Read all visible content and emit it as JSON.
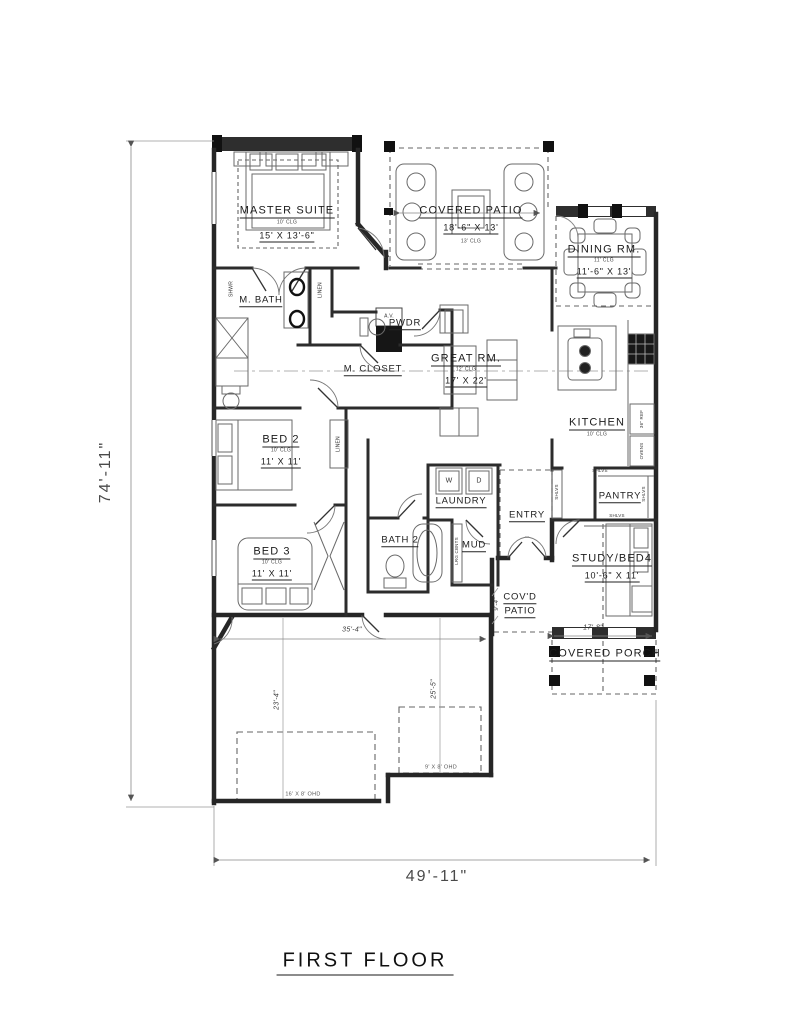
{
  "title": "FIRST FLOOR",
  "overall": {
    "height": "74'-11\"",
    "width": "49'-11\""
  },
  "rooms": {
    "master": {
      "name": "MASTER SUITE",
      "clg": "10' CLG",
      "size": "15' X 13'-6\""
    },
    "covered_patio": {
      "name": "COVERED PATIO",
      "size": "18'-6\" X 13'",
      "clg": "13' CLG"
    },
    "dining": {
      "name": "DINING RM.",
      "clg": "11' CLG",
      "size": "11'-6\" X 13'"
    },
    "m_bath": {
      "name": "M. BATH"
    },
    "pwdr": {
      "name": "PWDR"
    },
    "m_closet": {
      "name": "M. CLOSET"
    },
    "great": {
      "name": "GREAT RM.",
      "clg": "12' CLG",
      "size": "17' X 22'"
    },
    "kitchen": {
      "name": "KITCHEN",
      "clg": "10' CLG"
    },
    "pantry": {
      "name": "PANTRY"
    },
    "entry": {
      "name": "ENTRY"
    },
    "laundry": {
      "name": "LAUNDRY"
    },
    "bath2": {
      "name": "BATH 2"
    },
    "mud": {
      "name": "MUD"
    },
    "bed2": {
      "name": "BED 2",
      "clg": "10' CLG",
      "size": "11' X 11'"
    },
    "bed3": {
      "name": "BED 3",
      "clg": "10' CLG",
      "size": "11' X 11'"
    },
    "study": {
      "name": "STUDY/BED4",
      "size": "10'-6\" X 11'"
    },
    "covd_patio": {
      "l1": "COV'D",
      "l2": "PATIO"
    },
    "porch": {
      "name": "COVERED PORCH"
    }
  },
  "fixtures": {
    "shwr": "SHWR",
    "linen": "LINEN",
    "av": "A.V.",
    "washer": "W",
    "dryer": "D",
    "cbnts": "LRG CBNTS",
    "ref": "36\" REF",
    "ovens": "OVENS",
    "shlvs": "SHLVS"
  },
  "dims": {
    "garage_w": "35'-4\"",
    "garage_d1": "23'-4\"",
    "garage_d2": "25'-5\"",
    "porch_w": "17'-8\"",
    "patio_d": "9'-4\"",
    "ohd_16": "16' X 8' OHD",
    "ohd_9": "9' X 8' OHD"
  }
}
